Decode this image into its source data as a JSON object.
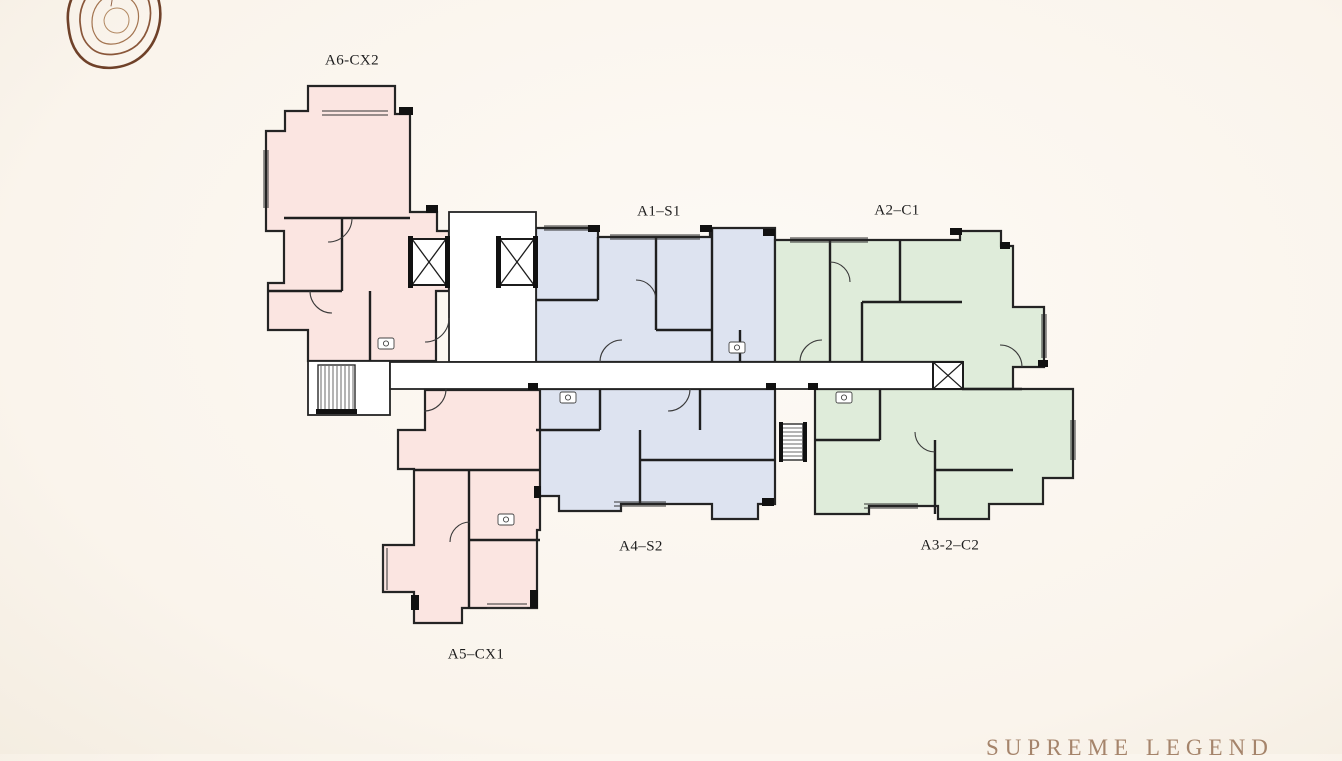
{
  "brand": {
    "wordmark": "SUPREME LEGEND",
    "wordmark_color": "#a5846b",
    "logo_icon": "tree-rings-logo",
    "logo_color": "#6f4129"
  },
  "page": {
    "background_color": "#faf4ec",
    "wall_color": "#222222",
    "corridor_color": "#ffffff"
  },
  "floorplan": {
    "units": [
      {
        "id": "a6-cx2",
        "label": "A6-CX2",
        "color": "#fbe5e1",
        "palette": "pink"
      },
      {
        "id": "a1-s1",
        "label": "A1–S1",
        "color": "#dde3f0",
        "palette": "blue"
      },
      {
        "id": "a2-c1",
        "label": "A2–C1",
        "color": "#dfecda",
        "palette": "green"
      },
      {
        "id": "a4-s2",
        "label": "A4–S2",
        "color": "#dde3f0",
        "palette": "blue"
      },
      {
        "id": "a3-2-c2",
        "label": "A3-2–C2",
        "color": "#dfecda",
        "palette": "green"
      },
      {
        "id": "a5-cx1",
        "label": "A5–CX1",
        "color": "#fbe5e1",
        "palette": "pink"
      }
    ],
    "features": {
      "elevator_icon": "x-in-box",
      "elevator_count": 3,
      "stairs_icon": "hatched-treads",
      "stairs_count": 2
    }
  }
}
